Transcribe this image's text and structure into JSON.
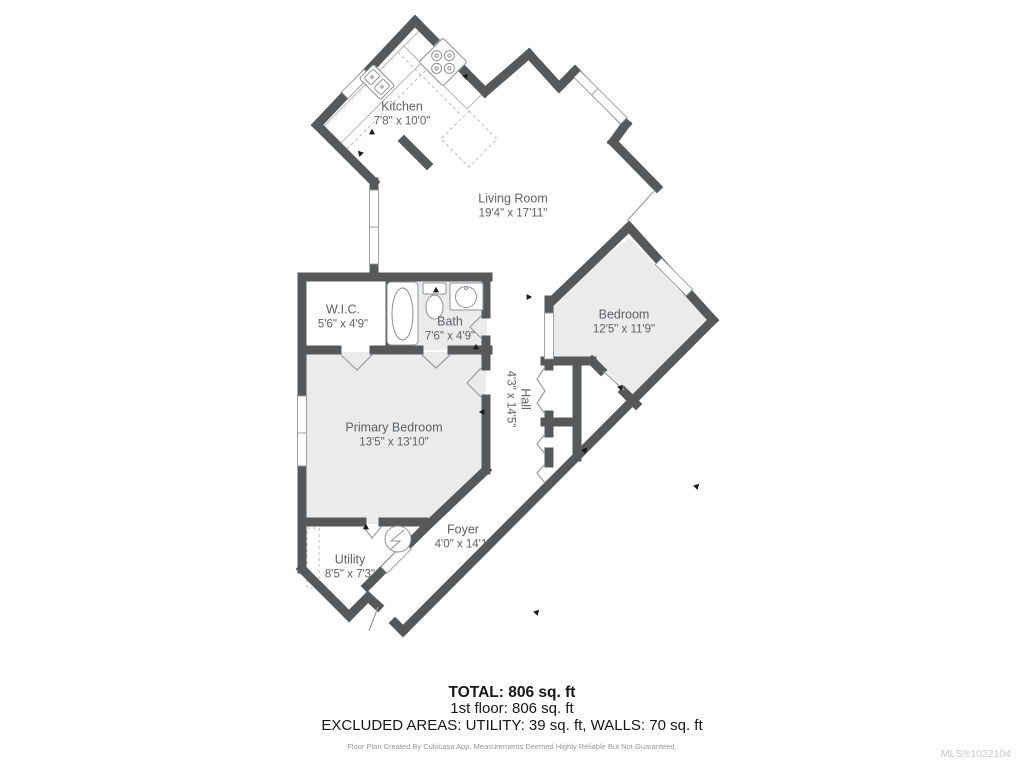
{
  "floor_plan": {
    "rooms": [
      {
        "id": "kitchen",
        "name": "Kitchen",
        "dimensions": "7'8\" x 10'0\""
      },
      {
        "id": "living-room",
        "name": "Living Room",
        "dimensions": "19'4\" x 17'11\""
      },
      {
        "id": "wic",
        "name": "W.I.C.",
        "dimensions": "5'6\" x 4'9\""
      },
      {
        "id": "bath",
        "name": "Bath",
        "dimensions": "7'6\" x 4'9\""
      },
      {
        "id": "bedroom",
        "name": "Bedroom",
        "dimensions": "12'5\" x 11'9\""
      },
      {
        "id": "primary-bedroom",
        "name": "Primary Bedroom",
        "dimensions": "13'5\" x 13'10\""
      },
      {
        "id": "hall",
        "name": "Hall",
        "dimensions": "4'3\" x 14'5\""
      },
      {
        "id": "foyer",
        "name": "Foyer",
        "dimensions": "4'0\" x 14'1\""
      },
      {
        "id": "utility",
        "name": "Utility",
        "dimensions": "8'5\" x 7'3\""
      }
    ],
    "fixtures": [
      "stove",
      "kitchen-sink",
      "bathtub",
      "toilet",
      "bathroom-sink",
      "water-heater"
    ],
    "colors": {
      "wall": "#57585a",
      "room_fill": "#ebebec",
      "fixture_outline": "#8f9092",
      "label_text": "#5f6062",
      "summary_text": "#161616",
      "mls_text": "#c9cacc"
    }
  },
  "summary": {
    "total": "TOTAL: 806 sq. ft",
    "first_floor": "1st floor: 806 sq. ft",
    "excluded_areas": "EXCLUDED AREAS: UTILITY: 39 sq. ft, WALLS: 70 sq. ft"
  },
  "footer": {
    "disclaimer": "Floor Plan Created By Cubicasa App. Measurements Deemed Highly Reliable But Not Guaranteed.",
    "mls_number": "MLS®1022104"
  }
}
